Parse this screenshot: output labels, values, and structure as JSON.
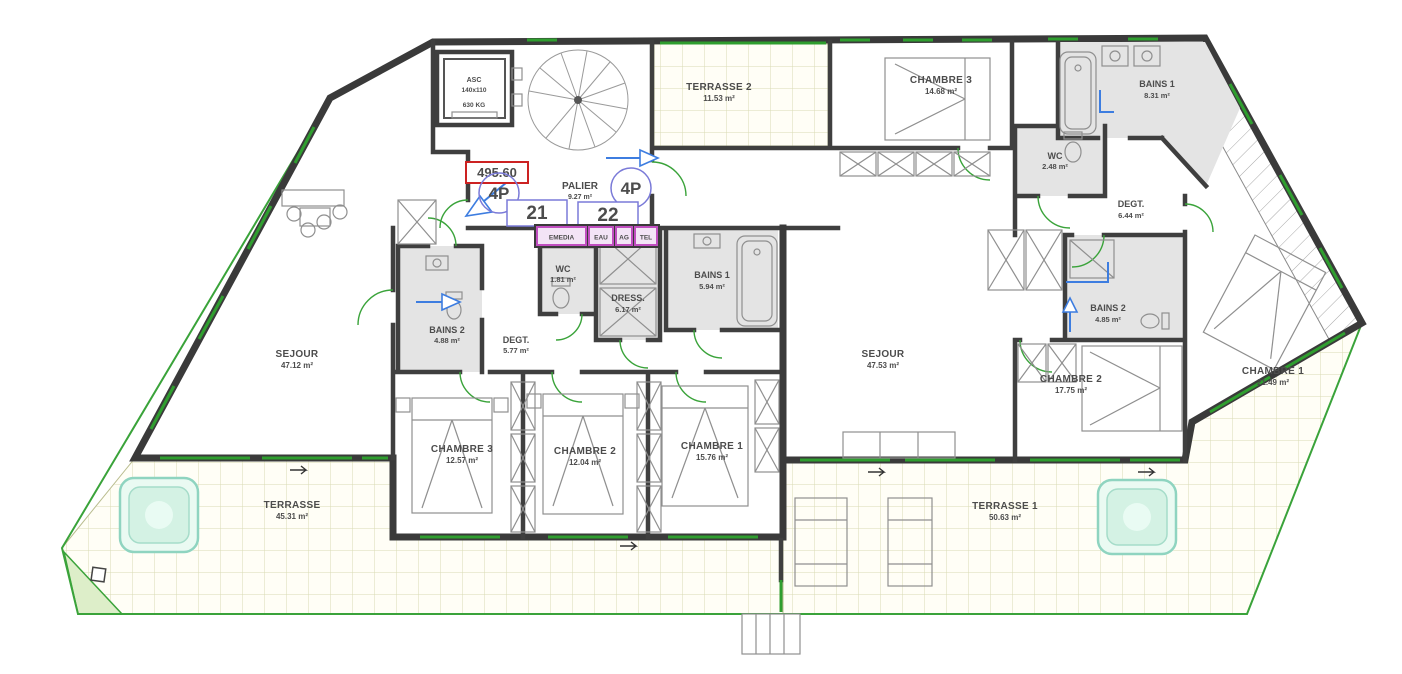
{
  "core": {
    "level_mark": "495.60",
    "palier": {
      "name": "PALIER",
      "area": "9.27 m²"
    },
    "elevator": {
      "label": "ASC",
      "dims": "140x110",
      "capacity": "630 KG"
    },
    "unit21_number": "21",
    "unit22_number": "22",
    "unit21_type": "4P",
    "unit22_type": "4P",
    "utilities": {
      "u1": "EMEDIA",
      "u2": "EAU",
      "u3": "AG",
      "u4": "TEL"
    }
  },
  "unit21": {
    "sejour": {
      "name": "SEJOUR",
      "area": "47.12 m²"
    },
    "bains2": {
      "name": "BAINS 2",
      "area": "4.88 m²"
    },
    "degt": {
      "name": "DEGT.",
      "area": "5.77 m²"
    },
    "wc": {
      "name": "WC",
      "area": "1.81 m²"
    },
    "dress": {
      "name": "DRESS.",
      "area": "6.17 m²"
    },
    "bains1": {
      "name": "BAINS 1",
      "area": "5.94 m²"
    },
    "chambre3": {
      "name": "CHAMBRE 3",
      "area": "12.57 m²"
    },
    "chambre2": {
      "name": "CHAMBRE 2",
      "area": "12.04 m²"
    },
    "chambre1": {
      "name": "CHAMBRE 1",
      "area": "15.76 m²"
    },
    "terrasse": {
      "name": "TERRASSE",
      "area": "45.31 m²"
    }
  },
  "unit22": {
    "terrasse2": {
      "name": "TERRASSE 2",
      "area": "11.53 m²"
    },
    "chambre3": {
      "name": "CHAMBRE 3",
      "area": "14.68 m²"
    },
    "bains1": {
      "name": "BAINS 1",
      "area": "8.31 m²"
    },
    "wc": {
      "name": "WC",
      "area": "2.48 m²"
    },
    "degt": {
      "name": "DEGT.",
      "area": "6.44 m²"
    },
    "sejour": {
      "name": "SEJOUR",
      "area": "47.53 m²"
    },
    "bains2": {
      "name": "BAINS 2",
      "area": "4.85 m²"
    },
    "chambre2": {
      "name": "CHAMBRE 2",
      "area": "17.75 m²"
    },
    "chambre1": {
      "name": "CHAMBRE 1",
      "area": "21.49 m²"
    },
    "terrasse1": {
      "name": "TERRASSE 1",
      "area": "50.63 m²"
    }
  },
  "colors": {
    "wall": "#3a3a3a",
    "window_green": "#2f9e2f",
    "accent_blue": "#3d7de0",
    "label_blue_violet": "#7a7ad8",
    "level_red": "#cc2222",
    "utility_magenta": "#c04ec0",
    "tile_line": "#d9dbb4",
    "spa_teal": "#8fd4c0"
  }
}
